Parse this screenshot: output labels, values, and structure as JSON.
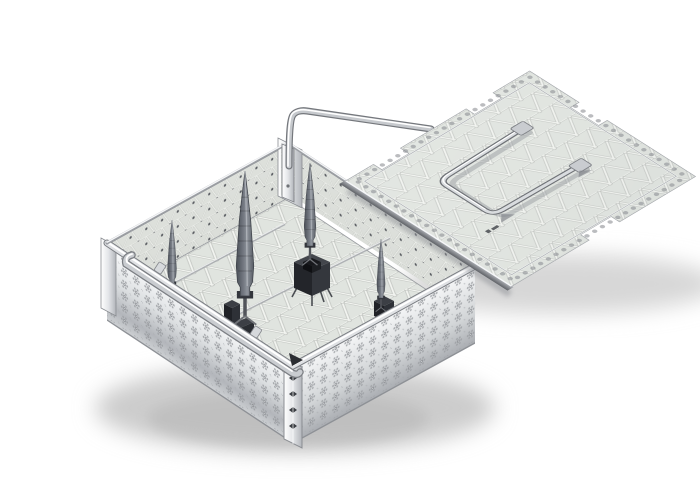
{
  "scene": {
    "description": "Product photo of a stainless steel perforated sterilization tray basket with a mesh lid set beside it, holding four grey tapered instruments in black silicone holders",
    "objects": {
      "basket": {
        "label": "perforated sterilization basket",
        "parts": {
          "bail_handle": "rear swing bail handle",
          "side_handle": "fold-down side handle",
          "floor": "triangular lattice mesh floor",
          "front_walls": "floral pierced outer walls",
          "rear_walls": "triangular mesh inner walls",
          "corner_post": "riveted corner post",
          "mounting_rails": "instrument mounting rails"
        }
      },
      "lid": {
        "label": "perforated mesh lid",
        "parts": {
          "plate": "triangular lattice plate",
          "handle": "flat-folding wire handle",
          "notches": "stacking notches",
          "border": "pierced dot border",
          "edge_rail": "folded edge rail",
          "etched_mark": "laser-etched marking"
        }
      },
      "contents": {
        "spikes": {
          "label": "grey tapered instrument tip",
          "count": 4
        },
        "holders": {
          "label": "black silicone instrument holder",
          "count": 3
        }
      }
    },
    "colors": {
      "background": "#ffffff",
      "metal_light": "#f4f5f6",
      "metal_mid": "#cfd2d4",
      "metal_dark": "#8e9196",
      "mesh_hole": "#e0e4df",
      "lattice_bright": "#f3f5f1",
      "lattice_shade": "#c2c5c1",
      "spike_grey": "#6b7078",
      "spike_dark": "#4a4f57",
      "holder_black": "#26282d",
      "shadow": "#cccccc"
    }
  }
}
